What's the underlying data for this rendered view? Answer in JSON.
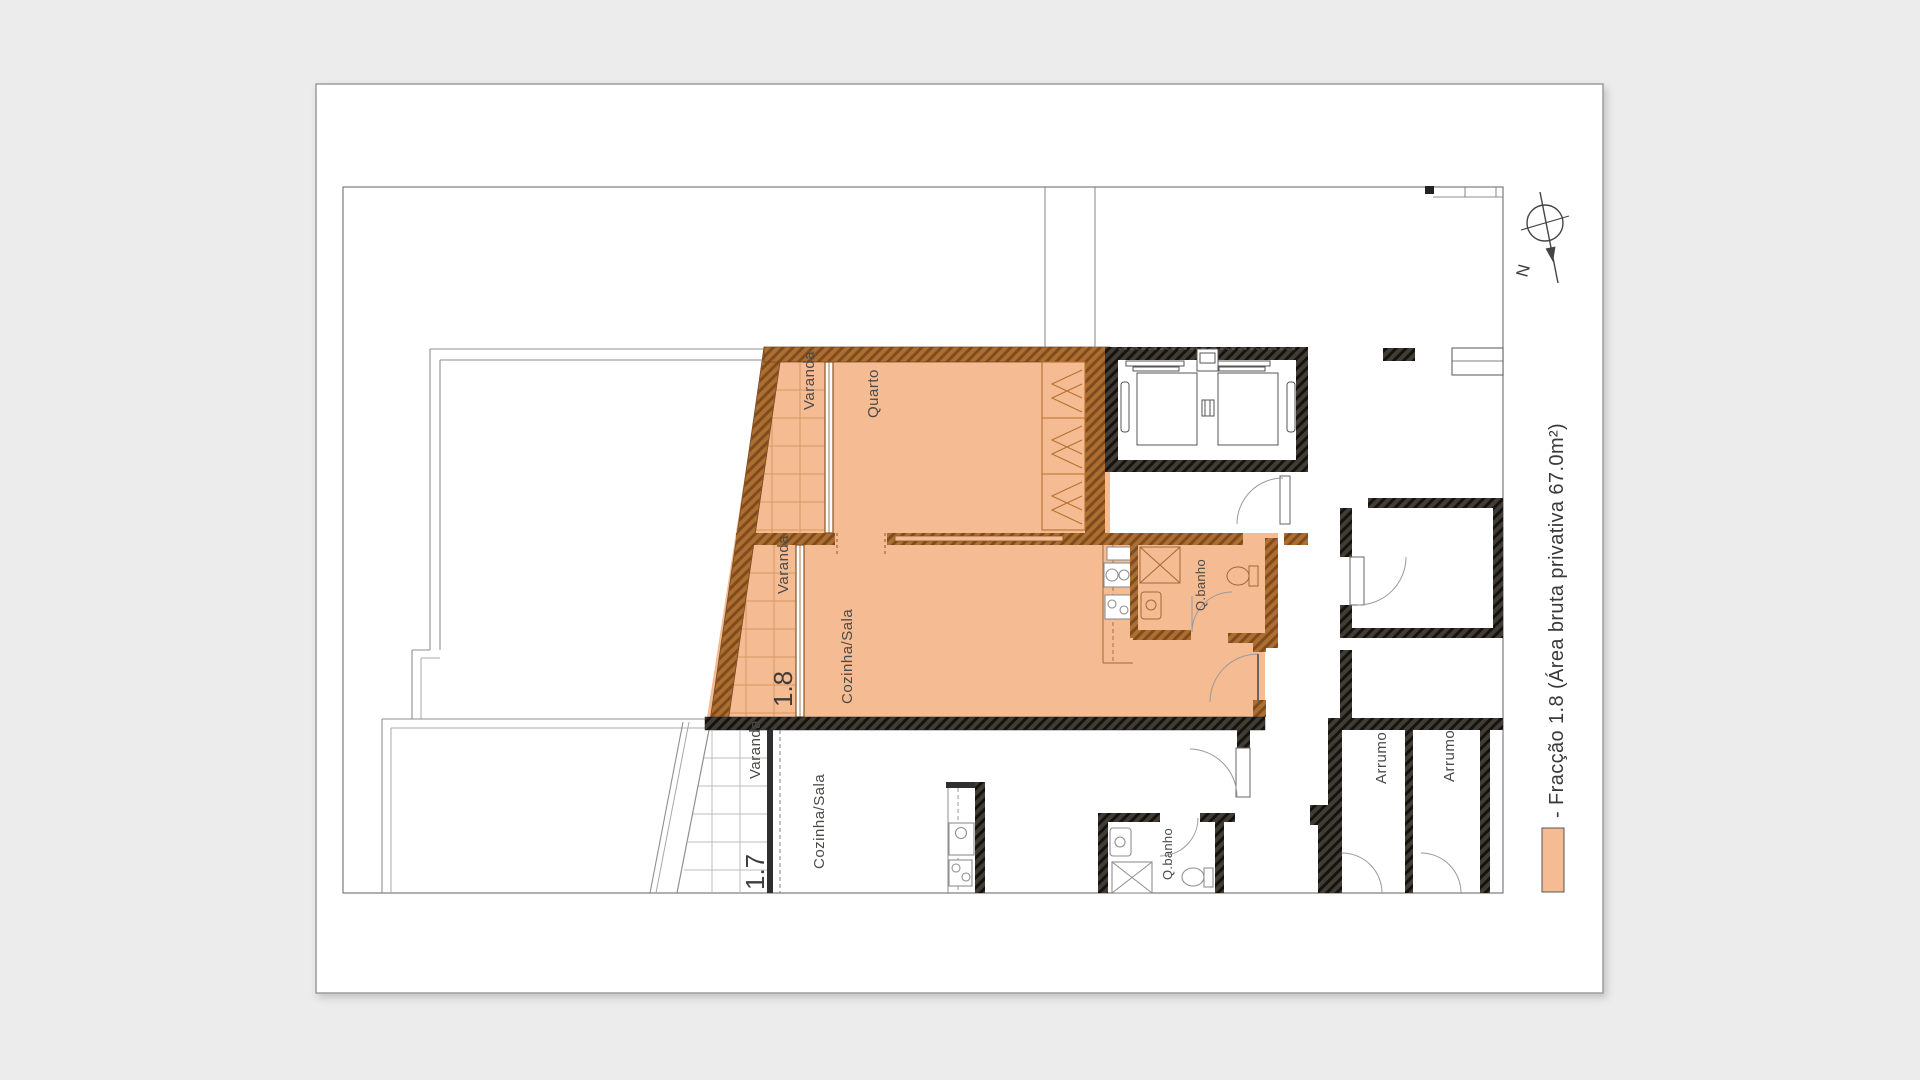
{
  "document": {
    "type": "architectural-floor-plan",
    "highlighted_fraction": "1.8",
    "area_bruta_privativa_m2": "67.0"
  },
  "colors": {
    "background": "#ececec",
    "sheet": "#ffffff",
    "unit_fill": "#f5bb92",
    "unit_grid": "#d69a62",
    "wall_brown": "#a96a2d",
    "wall_dark": "#35302b",
    "line_gray": "#8f8f8f",
    "text": "#4a4a48"
  },
  "north": {
    "label": "N"
  },
  "legend": {
    "text": "- Fracção 1.8 (Área bruta privativa 67.0m²)"
  },
  "units": {
    "u18": {
      "id": "1.8",
      "varanda_upper": "Varanda",
      "quarto": "Quarto",
      "varanda_lower": "Varanda",
      "cozinha_sala": "Cozinha/Sala",
      "qbanho": "Q.banho"
    },
    "u17": {
      "id": "1.7",
      "varanda": "Varanda",
      "cozinha_sala": "Cozinha/Sala",
      "qbanho": "Q.banho"
    },
    "common": {
      "arrumo_1": "Arrumo",
      "arrumo_2": "Arrumo"
    }
  }
}
